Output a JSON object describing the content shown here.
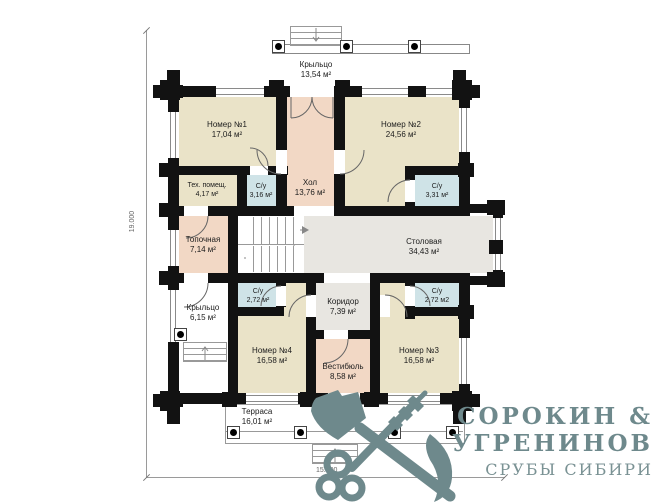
{
  "plan": {
    "rooms": [
      {
        "id": "porch-top",
        "name": "Крыльцо",
        "area": "13,54 м²"
      },
      {
        "id": "room-1",
        "name": "Номер №1",
        "area": "17,04 м²"
      },
      {
        "id": "room-2",
        "name": "Номер №2",
        "area": "24,56 м²"
      },
      {
        "id": "tech-room",
        "name": "Тех. помещ.",
        "area": "4,17 м²"
      },
      {
        "id": "wc-1",
        "name": "С/у",
        "area": "3,16 м²"
      },
      {
        "id": "hall",
        "name": "Хол",
        "area": "13,76 м²"
      },
      {
        "id": "wc-2",
        "name": "С/у",
        "area": "3,31 м²"
      },
      {
        "id": "boiler-room",
        "name": "Топочная",
        "area": "7,14 м²"
      },
      {
        "id": "dining-room",
        "name": "Столовая",
        "area": "34,43 м²"
      },
      {
        "id": "porch-left",
        "name": "Крыльцо",
        "area": "6,15 м²"
      },
      {
        "id": "wc-3",
        "name": "С/у",
        "area": "2,72 м²"
      },
      {
        "id": "corridor",
        "name": "Коридор",
        "area": "7,39 м²"
      },
      {
        "id": "wc-4",
        "name": "С/у",
        "area": "2,72 м2"
      },
      {
        "id": "room-4",
        "name": "Номер №4",
        "area": "16,58 м²"
      },
      {
        "id": "vestibule",
        "name": "Вестибюль",
        "area": "8,58 м²"
      },
      {
        "id": "room-3",
        "name": "Номер №3",
        "area": "16,01 м²"
      }
    ],
    "room_3_fix": {
      "name": "Номер №3",
      "area": "16,58 м²"
    },
    "terrace": {
      "name": "Терраса",
      "area": "16,01 м²"
    },
    "dimensions": {
      "vertical": "19.000",
      "horizontal": "15.300"
    },
    "colors": {
      "wall": "#121212",
      "room_beige": "#eae3c8",
      "room_pink": "#f2d8c5",
      "room_blue": "#cfe3e7",
      "room_gray": "#e8e6e1",
      "logo": "#6e898c"
    }
  },
  "logo": {
    "line1": "СОРОКИН &",
    "line2": "УГРЕНИНОВ",
    "line3": "СРУБЫ СИБИРИ",
    "emblem": "crossed-axe-and-key-icon"
  }
}
